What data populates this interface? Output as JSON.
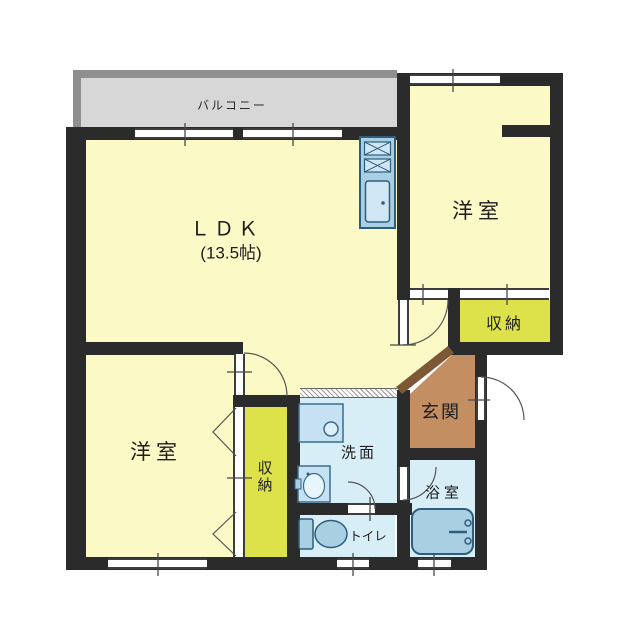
{
  "plan": {
    "type": "apartment-floorplan",
    "labels": {
      "balcony": "バルコニー",
      "ldk": "ＬＤＫ",
      "ldk_size": "(13.5帖)",
      "bedroom_ne": "洋室",
      "closet_ne": "収納",
      "entrance": "玄関",
      "bedroom_sw": "洋室",
      "closet_sw": "収納",
      "washroom": "洗面",
      "toilet": "トイレ",
      "bath": "浴室"
    },
    "colors": {
      "wall": "#2b2b2b",
      "room_yellow": "#fbf9c6",
      "closet_green": "#dde24b",
      "wet_blue": "#d8eef6",
      "fixture_blue": "#a9cfe3",
      "fixture_stroke": "#2f5d7e",
      "entrance_brown": "#c48e63",
      "entrance_step": "#7d5836",
      "balcony_fill": "#d7d7d7",
      "balcony_wall": "#8f8f8f"
    }
  }
}
